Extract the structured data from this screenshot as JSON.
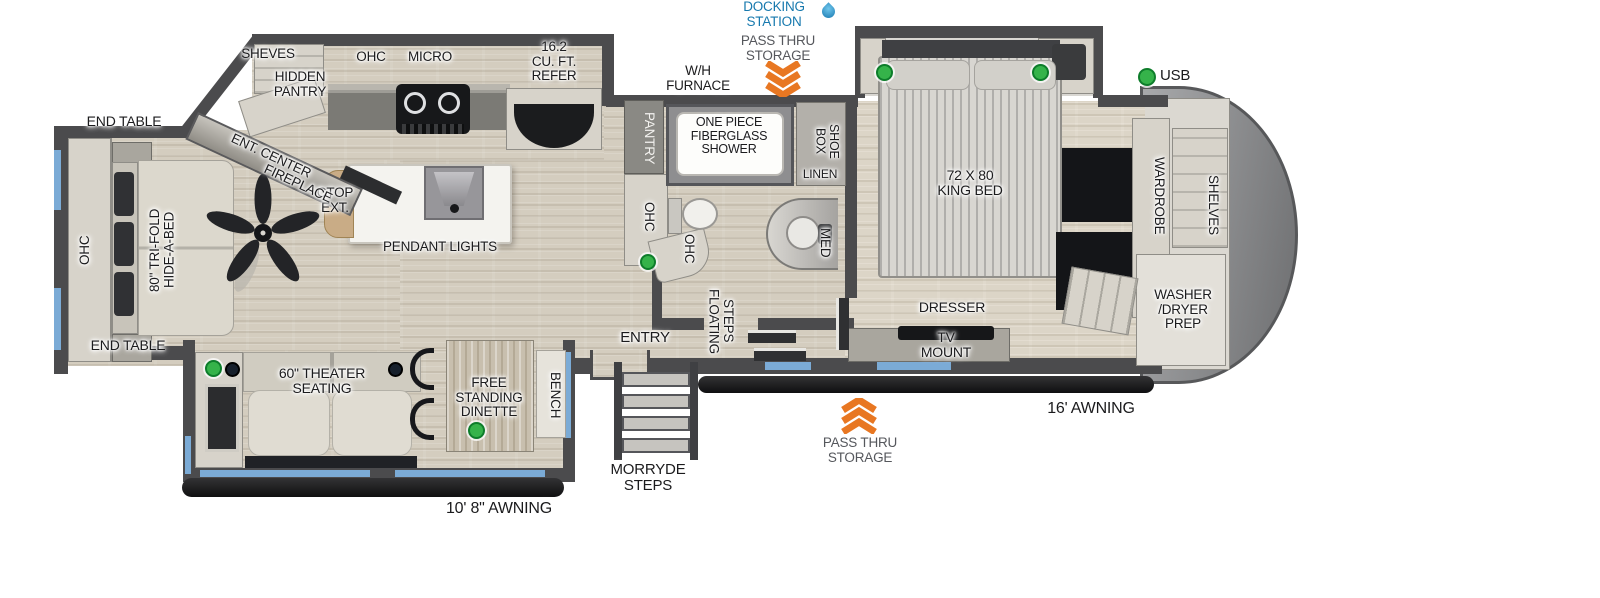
{
  "annotations_top": {
    "docking_station": "DOCKING\nSTATION",
    "pass_thru_storage": "PASS THRU\nSTORAGE",
    "wh_furnace": "W/H\nFURNACE"
  },
  "living_area": {
    "end_table_top": "END TABLE",
    "ohc": "OHC",
    "sofa": "80\" TRI-FOLD\nHIDE-A-BED",
    "end_table_bottom": "END TABLE",
    "ent_center": "ENT. CENTER",
    "fireplace": "FIREPLACE",
    "ctop_ext": "CTOP\nEXT.",
    "pendant_lights": "PENDANT LIGHTS"
  },
  "kitchen": {
    "sheves": "SHEVES",
    "hidden_pantry": "HIDDEN\nPANTRY",
    "ohc": "OHC",
    "micro": "MICRO",
    "refer": "16.2\nCU. FT.\nREFER",
    "pantry": "PANTRY",
    "ohc_counter": "OHC",
    "ohc_counter_2": "OHC"
  },
  "bathroom": {
    "shower": "ONE PIECE\nFIBERGLASS\nSHOWER",
    "shoe_box": "SHOE\nBOX",
    "linen": "LINEN",
    "med": "MED"
  },
  "hallway": {
    "floating_steps": "FLOATING\nSTEPS",
    "entry": "ENTRY"
  },
  "bedroom": {
    "king_bed": "72 X 80\nKING BED",
    "dresser": "DRESSER",
    "tv_mount": "TV\nMOUNT",
    "wardrobe": "WARDROBE",
    "shelves": "SHELVES",
    "washer_dryer_prep": "WASHER\n/DRYER\nPREP",
    "usb": "USB"
  },
  "door_side": {
    "theater_seating": "60\" THEATER\nSEATING",
    "dinette": "FREE\nSTANDING\nDINETTE",
    "bench": "BENCH",
    "morryde_steps": "MORRYDE\nSTEPS",
    "pass_thru_storage": "PASS THRU\nSTORAGE",
    "awning_door_side": "10' 8\" AWNING",
    "awning_off_door": "16' AWNING"
  },
  "colors": {
    "docking_blue": "#1779ae",
    "pass_thru_orange": "#e87722",
    "usb_green": "#35b34a",
    "window_blue": "#7babd6"
  }
}
